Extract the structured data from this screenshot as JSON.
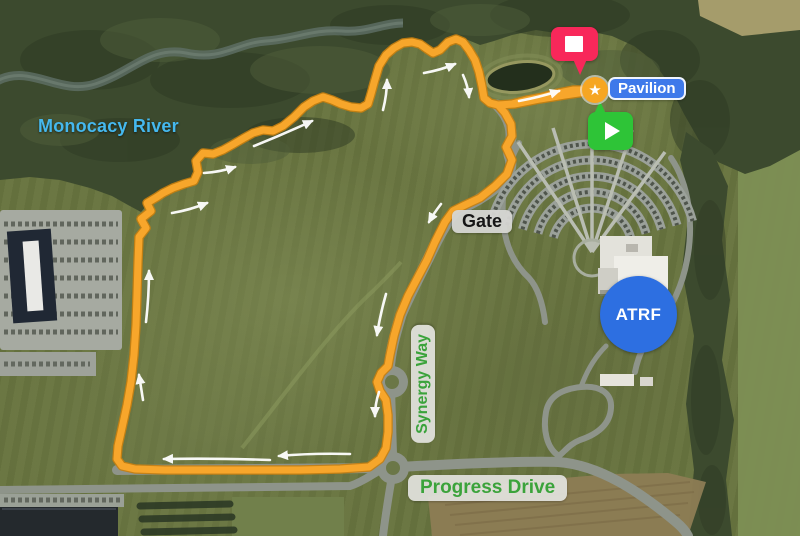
{
  "labels": {
    "river": "Monocacy River",
    "pavilion": "Pavilion",
    "gate": "Gate",
    "synergy_way": "Synergy Way",
    "progress_drive": "Progress Drive",
    "atrf": "ATRF"
  },
  "markers": {
    "waypoint": {
      "icon": "star",
      "glyph": "★"
    },
    "start": {
      "icon": "play"
    },
    "finish": {
      "icon": "stop"
    }
  },
  "colors": {
    "route": "#F7A62B",
    "route-edge": "#C9800E",
    "arrow": "#FFFFFF",
    "river-label": "#45B8EE",
    "pavilion-bg": "#3E79EA",
    "road-label-green": "#3BA33B",
    "atrf-bg": "#2D6FE1",
    "start-marker": "#2EC437",
    "finish-marker": "#F8285A",
    "star-badge": "#F6A623"
  },
  "route": {
    "points": [
      [
        592,
        91
      ],
      [
        565,
        95
      ],
      [
        540,
        99
      ],
      [
        515,
        104
      ],
      [
        498,
        105
      ],
      [
        505,
        113
      ],
      [
        511,
        124
      ],
      [
        512,
        136
      ],
      [
        506,
        147
      ],
      [
        512,
        160
      ],
      [
        507,
        174
      ],
      [
        495,
        186
      ],
      [
        480,
        198
      ],
      [
        465,
        205
      ],
      [
        453,
        211
      ],
      [
        445,
        222
      ],
      [
        435,
        242
      ],
      [
        427,
        260
      ],
      [
        418,
        277
      ],
      [
        408,
        296
      ],
      [
        400,
        315
      ],
      [
        394,
        336
      ],
      [
        390,
        355
      ],
      [
        388,
        366
      ],
      [
        381,
        373
      ],
      [
        377,
        382
      ],
      [
        380,
        391
      ],
      [
        386,
        400
      ],
      [
        388,
        415
      ],
      [
        388,
        432
      ],
      [
        386,
        448
      ],
      [
        380,
        459
      ],
      [
        369,
        467
      ],
      [
        340,
        469
      ],
      [
        300,
        470
      ],
      [
        255,
        470
      ],
      [
        210,
        470
      ],
      [
        165,
        470
      ],
      [
        135,
        469
      ],
      [
        122,
        466
      ],
      [
        117,
        459
      ],
      [
        118,
        446
      ],
      [
        122,
        428
      ],
      [
        127,
        405
      ],
      [
        131,
        382
      ],
      [
        134,
        355
      ],
      [
        136,
        325
      ],
      [
        137,
        295
      ],
      [
        138,
        262
      ],
      [
        139,
        237
      ],
      [
        146,
        228
      ],
      [
        141,
        219
      ],
      [
        151,
        211
      ],
      [
        147,
        203
      ],
      [
        157,
        197
      ],
      [
        163,
        193
      ],
      [
        173,
        188
      ],
      [
        184,
        184
      ],
      [
        194,
        181
      ],
      [
        198,
        172
      ],
      [
        196,
        161
      ],
      [
        203,
        153
      ],
      [
        213,
        154
      ],
      [
        223,
        150
      ],
      [
        232,
        145
      ],
      [
        244,
        138
      ],
      [
        253,
        133
      ],
      [
        263,
        130
      ],
      [
        273,
        131
      ],
      [
        283,
        126
      ],
      [
        294,
        117
      ],
      [
        304,
        107
      ],
      [
        313,
        101
      ],
      [
        323,
        97
      ],
      [
        332,
        100
      ],
      [
        341,
        104
      ],
      [
        351,
        107
      ],
      [
        361,
        108
      ],
      [
        368,
        104
      ],
      [
        371,
        94
      ],
      [
        374,
        83
      ],
      [
        379,
        66
      ],
      [
        386,
        55
      ],
      [
        394,
        48
      ],
      [
        403,
        43
      ],
      [
        412,
        42
      ],
      [
        420,
        44
      ],
      [
        427,
        49
      ],
      [
        433,
        53
      ],
      [
        440,
        50
      ],
      [
        448,
        42
      ],
      [
        456,
        39
      ],
      [
        463,
        42
      ],
      [
        469,
        50
      ],
      [
        475,
        60
      ],
      [
        479,
        72
      ],
      [
        482,
        86
      ],
      [
        484,
        98
      ],
      [
        490,
        103
      ],
      [
        498,
        105
      ],
      [
        512,
        104
      ],
      [
        527,
        100
      ],
      [
        543,
        97
      ],
      [
        558,
        93
      ],
      [
        573,
        90
      ],
      [
        589,
        90
      ]
    ],
    "arrows": [
      [
        270,
        460,
        213,
        458,
        164,
        459
      ],
      [
        350,
        454,
        312,
        453,
        279,
        456
      ],
      [
        146,
        322,
        149,
        296,
        149,
        271
      ],
      [
        143,
        400,
        141,
        387,
        139,
        375
      ],
      [
        172,
        213,
        190,
        210,
        207,
        203
      ],
      [
        204,
        173,
        220,
        172,
        235,
        167
      ],
      [
        254,
        146,
        284,
        134,
        312,
        121
      ],
      [
        383,
        110,
        387,
        94,
        387,
        80
      ],
      [
        424,
        73,
        441,
        70,
        455,
        64
      ],
      [
        463,
        75,
        468,
        86,
        469,
        97
      ],
      [
        519,
        101,
        540,
        97,
        559,
        91
      ],
      [
        441,
        204,
        434,
        213,
        429,
        222
      ],
      [
        386,
        294,
        380,
        315,
        377,
        335
      ],
      [
        379,
        392,
        375,
        404,
        375,
        416
      ]
    ]
  }
}
